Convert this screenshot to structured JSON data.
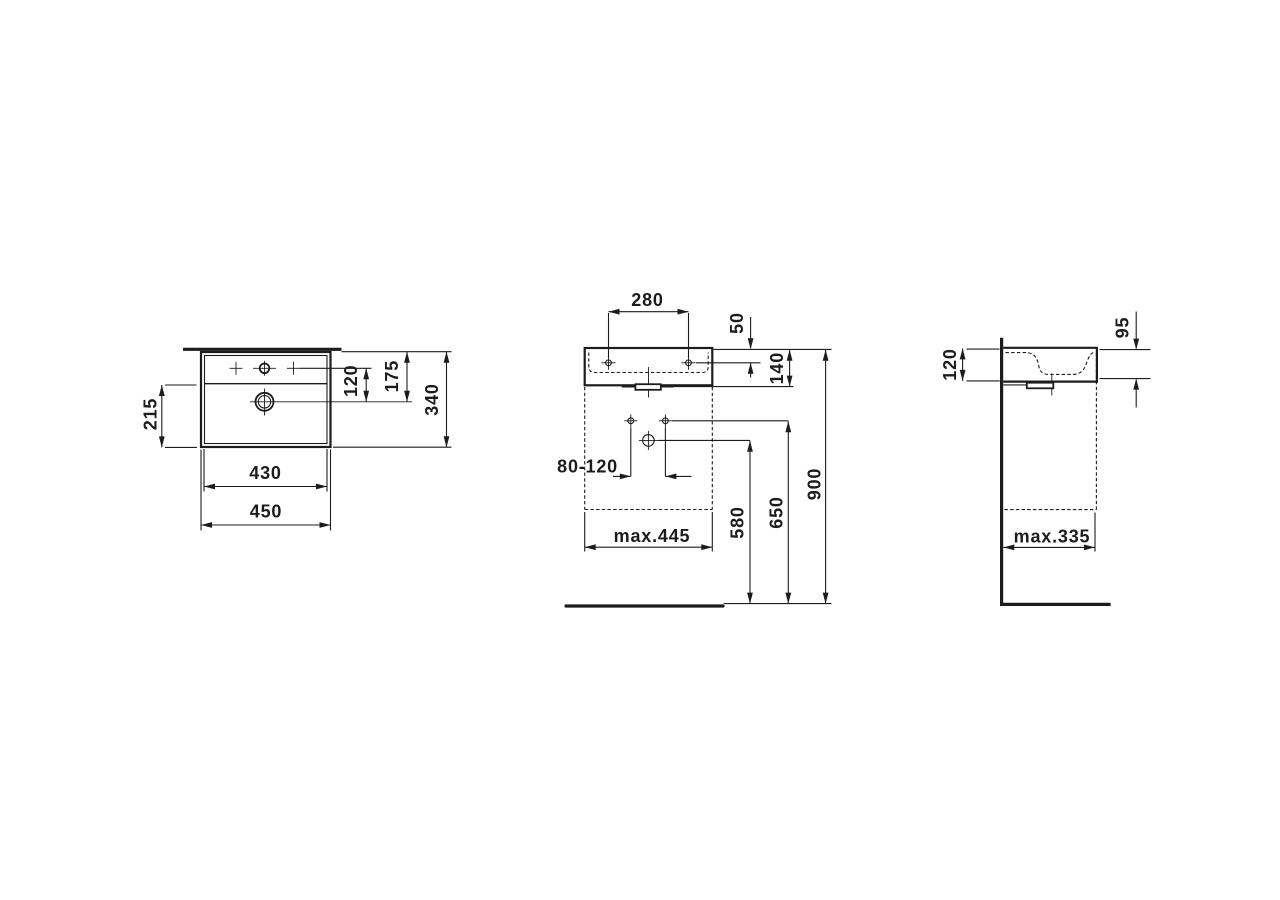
{
  "drawing": {
    "product": "wall-mounted washbasin technical dimension drawing",
    "line_color": "#1c1c1c",
    "views": {
      "top": {
        "name": "top view",
        "dims": {
          "overall_width": "450",
          "inner_width": "430",
          "overall_depth": "340",
          "bowl_front_depth": "215",
          "tapline_to_drain": "120",
          "back_to_drain": "175"
        }
      },
      "front": {
        "name": "front view",
        "dims": {
          "tap_hole_spacing": "280",
          "rim_to_fixing_holes": "50",
          "basin_height": "140",
          "rim_height": "900",
          "fixing_hole_height": "650",
          "drain_outlet_height": "580",
          "outlet_offset_range": "80-120",
          "max_width": "max.445"
        }
      },
      "side": {
        "name": "side view",
        "dims": {
          "wall_edge_height": "120",
          "front_edge_height": "95",
          "max_depth": "max.335"
        }
      }
    }
  }
}
